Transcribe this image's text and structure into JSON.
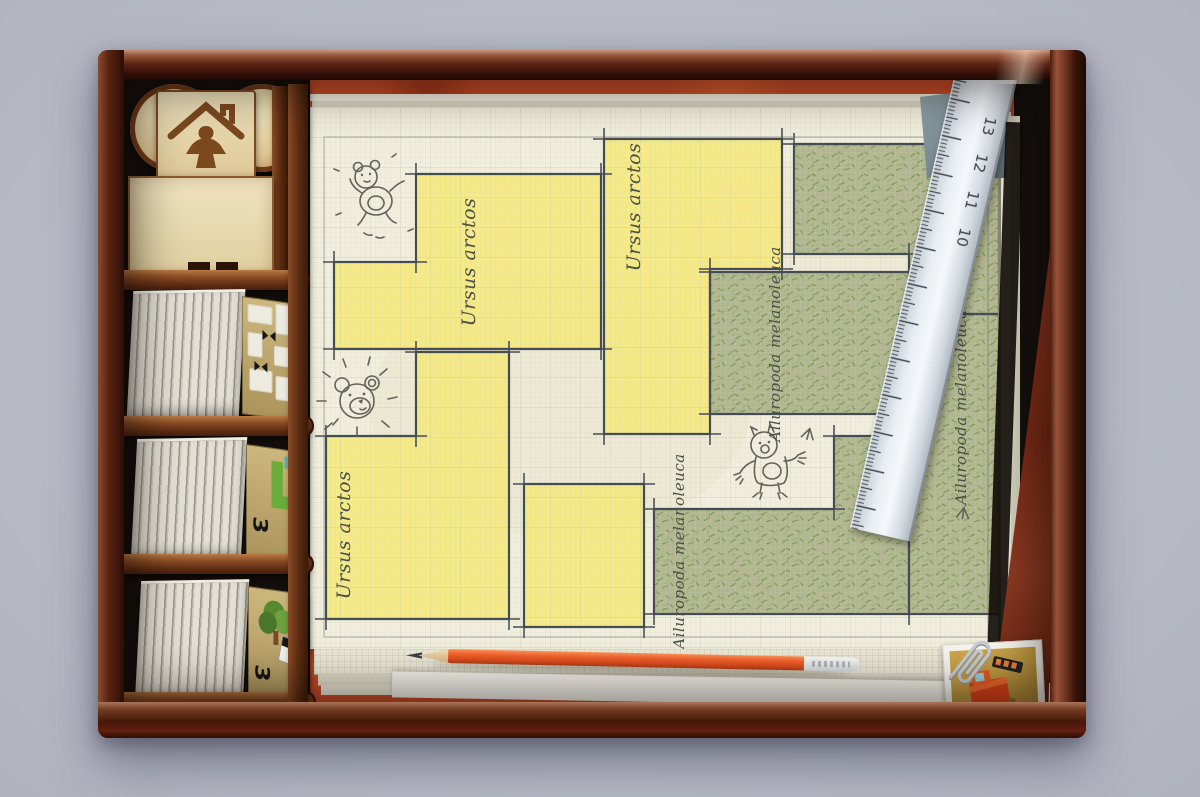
{
  "map": {
    "labels": [
      "Ursus arctos",
      "Ursus arctos",
      "Ursus arctos",
      "Ailuropoda melanoleuca",
      "Ailuropoda melanoleuca",
      "Ailuropoda melanoleuca"
    ],
    "sketches": [
      "teddy-bear",
      "bear-face-shining",
      "standing-bear",
      "bird-tracks"
    ],
    "colors": {
      "paper": "#f1eedd",
      "grid": "#c9cfba",
      "bear_enclosure": "#f5e981",
      "panda_enclosure": "#aab388",
      "outline": "#454d54"
    }
  },
  "ruler": {
    "numbers": [
      "13",
      "12",
      "11",
      "10"
    ]
  },
  "tiles": {
    "numbers": [
      "3",
      "3"
    ],
    "tetromino_color": "#6cae3c"
  },
  "insert": {
    "logo_icon": "meeple-house"
  },
  "colors": {
    "box": "#5a2114",
    "table": "#b6b9c4",
    "board": "#c74b26",
    "pencil": "#ef5c2a"
  }
}
